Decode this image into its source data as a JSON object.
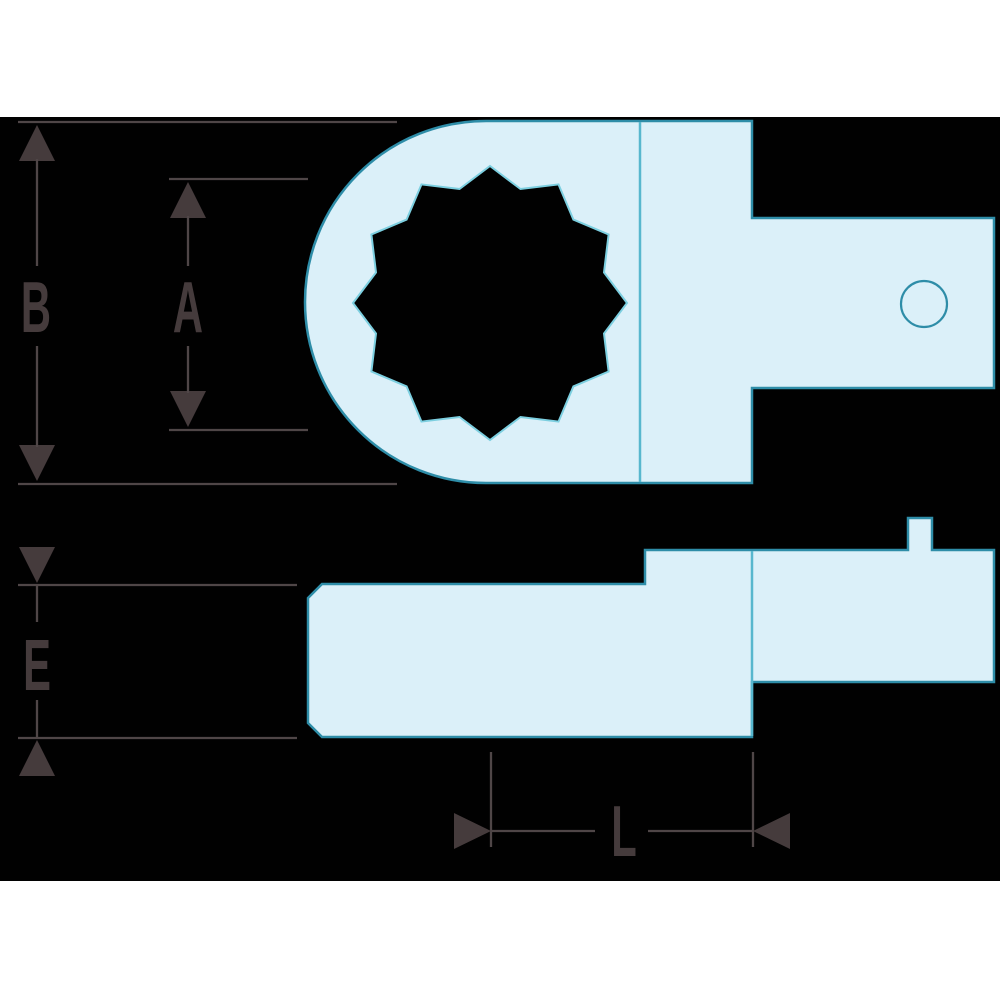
{
  "drawing": {
    "title": "Ring end attachment technical drawing",
    "views": {
      "top_view": "ring head with rectangular tang, 12-point opening, pin hole",
      "side_view": "flat profile with square drive peg"
    },
    "dimensions": {
      "b": "B",
      "a": "A",
      "e": "E",
      "l": "L"
    }
  },
  "colors": {
    "page-white": "#ffffff",
    "canvas-black": "#010101",
    "part-fill": "#dbf0f9",
    "part-outline": "#2e8da8",
    "inner-line": "#57b7ce",
    "hole-outline": "#7ccfe0",
    "dim-line": "#4f4647",
    "dim-strong": "#453b3c"
  }
}
